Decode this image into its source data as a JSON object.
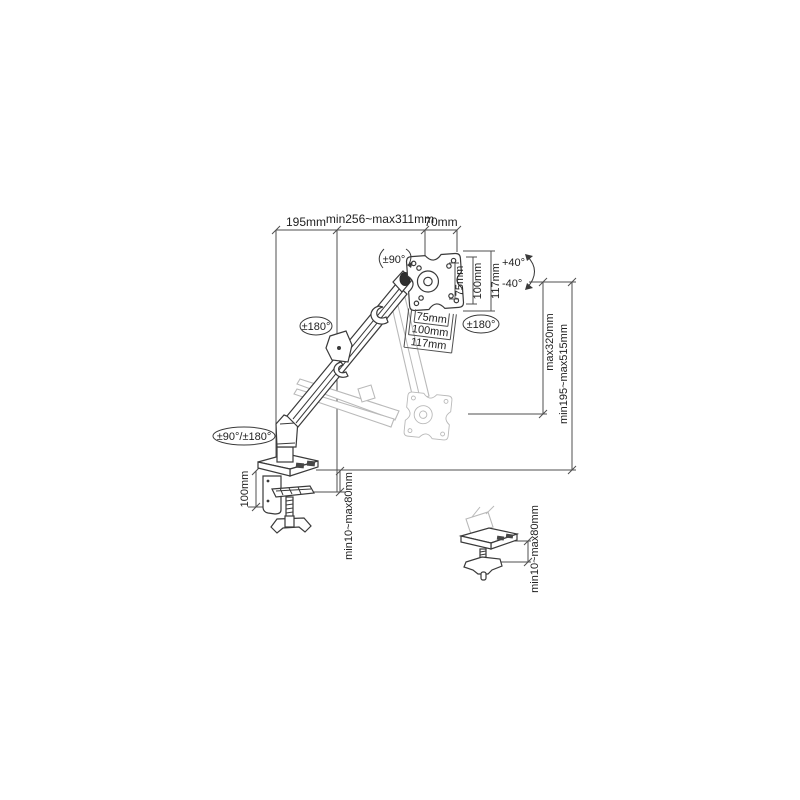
{
  "colors": {
    "background": "#ffffff",
    "line": "#3a3a3a",
    "dimension": "#4f4f4f",
    "ghost": "#b9b9b9",
    "text": "#1f1f1f"
  },
  "dimensions": {
    "top": {
      "arm_offset": "195mm",
      "arm_reach_range": "min256~max311mm",
      "head_depth": "70mm"
    },
    "vesa_vertical": {
      "inner": "75mm",
      "middle": "100mm",
      "outer": "117mm"
    },
    "vesa_horizontal": {
      "inner": "75mm",
      "middle": "100mm",
      "outer": "117mm"
    },
    "height": {
      "max_lift": "max320mm",
      "range": "min195~max515mm"
    },
    "clamp": {
      "body_height": "100mm",
      "desk_thickness": "min10~max80mm"
    },
    "grommet": {
      "desk_thickness": "min10~max80mm"
    }
  },
  "angles": {
    "head_swivel": "±90°",
    "arm_rotation": "±180°",
    "head_rotation": "±180°",
    "base_rotation": "±90°/±180°",
    "tilt_up": "+40°",
    "tilt_down": "-40°"
  }
}
